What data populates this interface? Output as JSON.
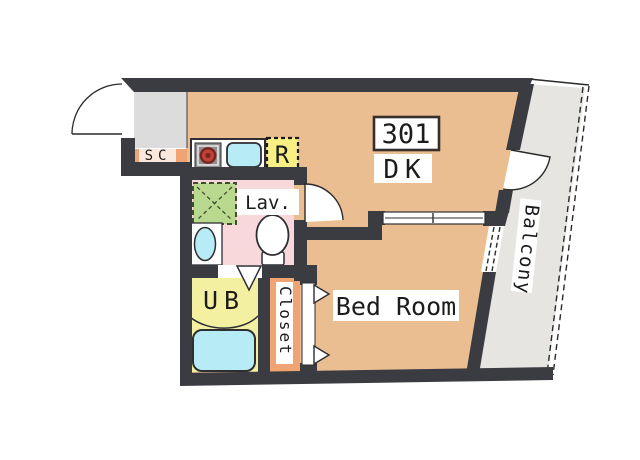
{
  "plan": {
    "unit_number": "301",
    "labels": {
      "dk": "DK",
      "bed_room": "Bed Room",
      "lavatory": "Lav.",
      "unit_bath": "UB",
      "closet": "Closet",
      "balcony": "Balcony",
      "shoe_cupboard": "SC",
      "refrigerator": "R"
    },
    "fixtures": {
      "stove": "stove-burner-icon",
      "sink": "kitchen-sink-icon",
      "refrigerator_space": "refrigerator-space-icon",
      "laundry_space": "washing-machine-space-icon",
      "wash_basin": "wash-basin-icon",
      "toilet": "toilet-icon",
      "bathtub": "bathtub-icon"
    }
  },
  "colors": {
    "wall": "#3b3b42",
    "room_floor": "#ebbe92",
    "entrance": "#dcdcdc",
    "balcony": "#e6e5e2",
    "lavatory": "#f8d8da",
    "unit_bath": "#f4f0a1",
    "closet": "#f0a473",
    "shoe_cupboard": "#f0a473",
    "refrigerator": "#f9f083",
    "washer": "#b9d98f",
    "washer_border": "#3f5030",
    "water_cyan": "#b7ebf5",
    "stove_gray": "#8f8f8f",
    "burner_red": "#bf4438",
    "burner_ring": "#7c241e",
    "label_bg": "#ffffff",
    "text": "#1c1c1c"
  }
}
